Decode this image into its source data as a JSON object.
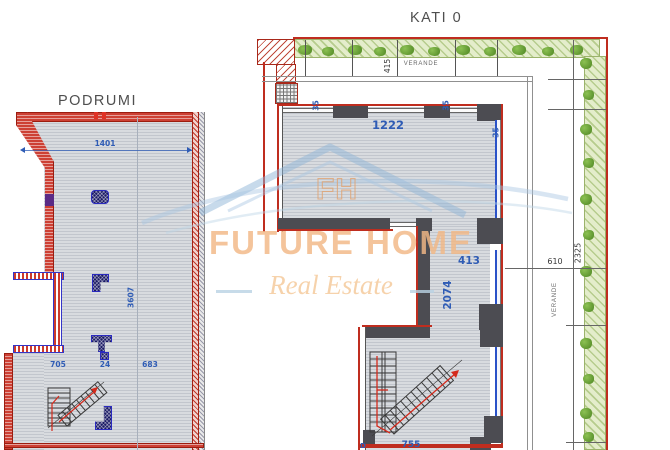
{
  "colors": {
    "wall-red": "#bf2d1f",
    "wall-dark": "#4c4c52",
    "dim-blue": "#2f5cb5",
    "dim-dark": "#3a3a3a",
    "floor-line": "#c2c6cd",
    "floor-base": "#d8dbdf",
    "hedge-base": "#e4edcb",
    "brand-orange": "#f2b886",
    "tagline-orange": "#f6cfa4",
    "column-blue": "#2a2ac0"
  },
  "podrumi": {
    "title": "PODRUMI",
    "dims": {
      "width": "1401",
      "depth": "3607",
      "bottom": [
        "705",
        "24",
        "683"
      ]
    }
  },
  "kati0": {
    "title": "KATI 0",
    "veranda_top_label": "VERANDE",
    "veranda_right_label": "VERANDE",
    "dims": {
      "veranda_depth": "415",
      "living_width": "1222",
      "wall_a": "35",
      "wall_b": "35",
      "wall_c": "35",
      "mid_width": "413",
      "mid_depth": "2074",
      "right_offset": "610",
      "right_depth": "2325",
      "bottom_width": "755",
      "door": "D"
    }
  },
  "watermark": {
    "monogram": "FH",
    "brand": "FUTURE HOME",
    "tagline": "Real Estate"
  }
}
